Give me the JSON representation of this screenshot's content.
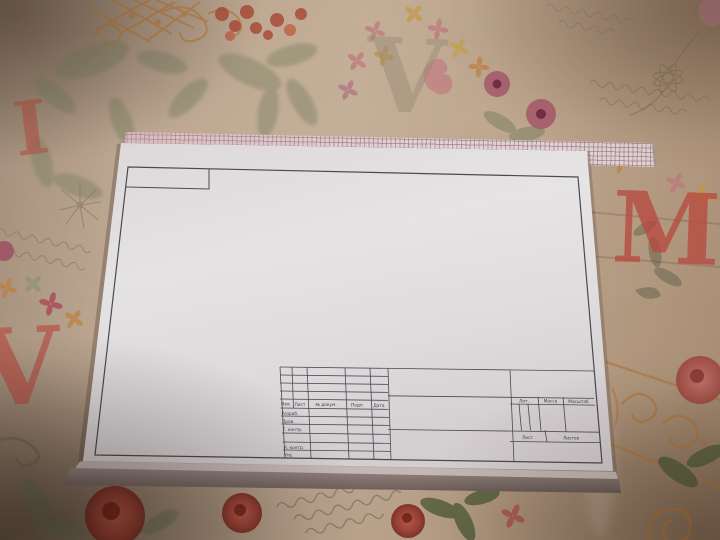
{
  "title_block": {
    "revision_header": {
      "izm": "Изм.",
      "list": "Лист",
      "doc": "№ докум.",
      "podp": "Подп.",
      "data": "Дата"
    },
    "rows": {
      "razrab": "Разраб.",
      "prov": "Пров.",
      "tkontr": "Т. контр.",
      "nkontr": "Н. контр.",
      "utv": "Утв."
    },
    "props": {
      "lit": "Лит.",
      "massa": "Масса",
      "masshtab": "Масштаб",
      "list": "Лист",
      "listov": "Листов"
    }
  },
  "fabric": {
    "letters": {
      "ghost_v": "V",
      "red_m": "M",
      "red_i": "I",
      "red_v": "V"
    },
    "colors": {
      "base": "#c4ae98",
      "letter_red": "#c0544a",
      "ornament_orange": "#bd7c35",
      "leaf_green": "#7d8566",
      "flower_red": "#b5483c",
      "aster_pink": "#ad5670",
      "script_gray": "#7c7164"
    }
  },
  "sheet": {
    "paper_color": "#f1eef0",
    "line_color": "#4c4e5a",
    "grid_paper_color": "#ebdfe0",
    "pad_edge_color": "#8a7a78"
  }
}
